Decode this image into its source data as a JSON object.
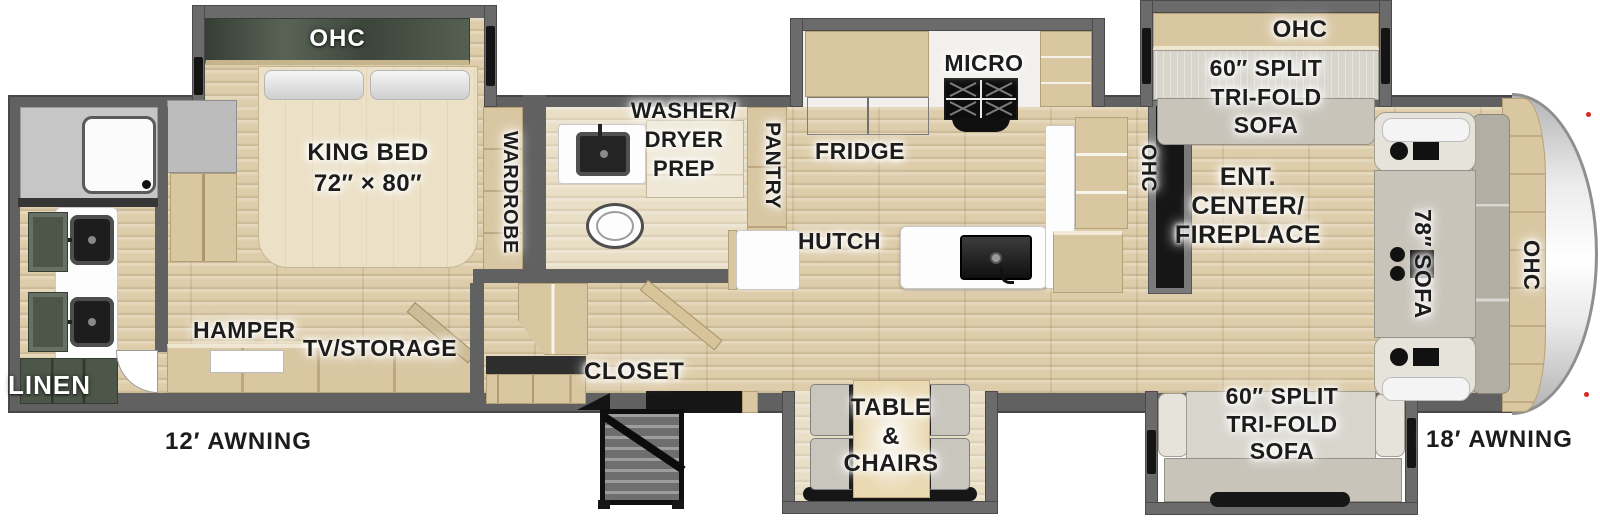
{
  "labels": {
    "rear_bath": {
      "linen": "LINEN"
    },
    "bedroom": {
      "ohc": "OHC",
      "bed": [
        "KING BED",
        "72″ × 80″"
      ],
      "wardrobe": "WARDROBE",
      "hamper": "HAMPER",
      "tv_storage": "TV/STORAGE"
    },
    "mid_bath": {
      "washer_dryer": [
        "WASHER/",
        "DRYER",
        "PREP"
      ],
      "pantry": "PANTRY"
    },
    "entry": {
      "closet": "CLOSET"
    },
    "kitchen": {
      "fridge": "FRIDGE",
      "micro": "MICRO",
      "hutch": "HUTCH",
      "ohc": "OHC"
    },
    "dinette": {
      "table_chairs": [
        "TABLE",
        "&",
        "CHAIRS"
      ]
    },
    "living": {
      "ent_center": [
        "ENT.",
        "CENTER/",
        "FIREPLACE"
      ],
      "ohc_top": "OHC",
      "sofa_top": [
        "60″ SPLIT",
        "TRI-FOLD",
        "SOFA"
      ],
      "sofa_bottom": [
        "60″ SPLIT",
        "TRI-FOLD",
        "SOFA"
      ]
    },
    "front_cap": {
      "sofa": "78″ SOFA",
      "ohc": "OHC"
    },
    "awning_left": "12′ AWNING",
    "awning_right": "18′ AWNING"
  },
  "colors": {
    "wall_gray": "#616161",
    "floor_wood": "#decdaa",
    "cabinet_wood": "#d9c7a2",
    "cabinet_dark_green": "#4c5749",
    "sofa_gray": "#d8d5cd",
    "counter_white": "#fdfdfd",
    "appliance_black": "#161616",
    "label_text": "#1c1c1c",
    "marker_light_red": "#d42b1e"
  }
}
